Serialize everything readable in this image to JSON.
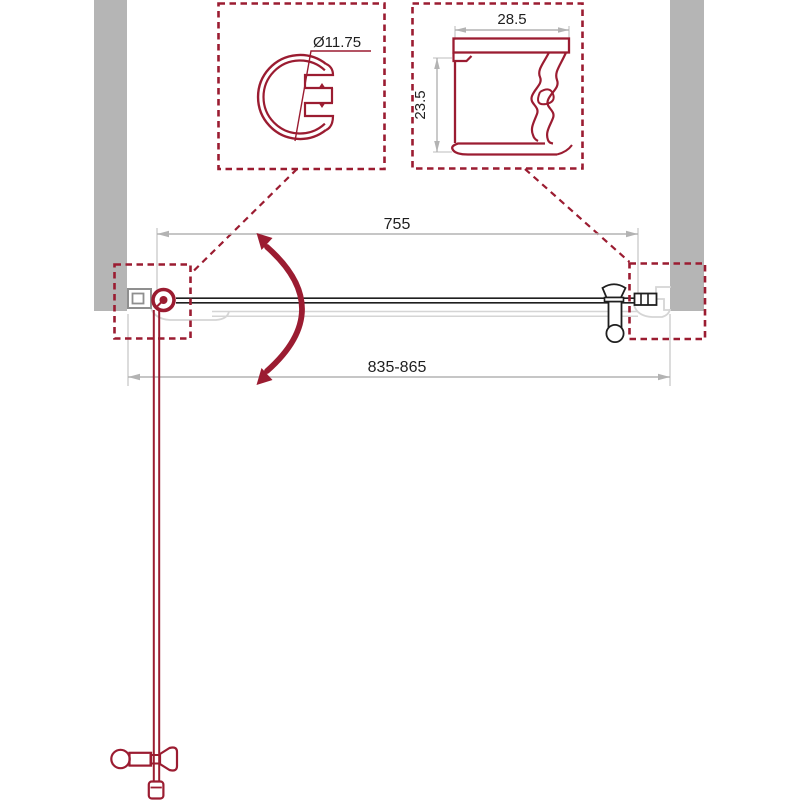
{
  "drawing": {
    "dimensions": {
      "knob_diameter": "Ø11.75",
      "wall_profile_width": "28.5",
      "wall_profile_depth": "23.5",
      "glass_width": "755",
      "opening_width": "835-865"
    },
    "colors": {
      "accent": "#9b1c31",
      "wall": "#b5b5b5",
      "dim": "#b3b3b3",
      "ext": "#c9c9c9",
      "ink": "#1f1f1f",
      "light": "#d5d5d5",
      "bracket": "#8f8f8f"
    }
  }
}
